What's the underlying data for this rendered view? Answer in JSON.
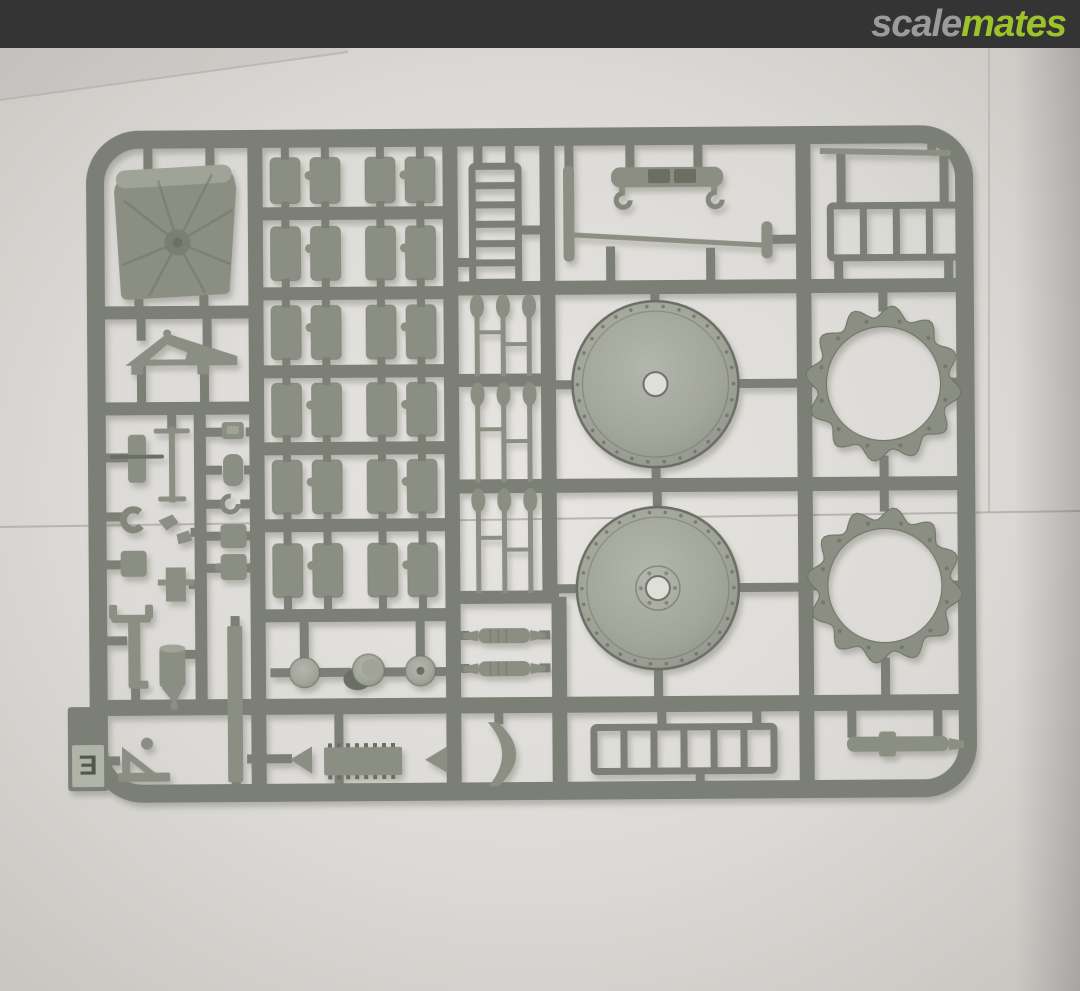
{
  "header": {
    "logo": {
      "scale": "scale",
      "mates": "mates"
    }
  },
  "sprue": {
    "letter": "E"
  },
  "colors": {
    "topbar": "#343434",
    "logo_scale": "#9b9b9b",
    "logo_mates": "#9cc42a",
    "backdrop": "#cac7c3",
    "paper_center": "#e7e5e1",
    "runner": "#7c7f75",
    "plastic": "#8b8e83",
    "plastic_light": "#a0a398",
    "plastic_dark": "#6b6e63",
    "seam": "#b2afac",
    "letter": "#54574d"
  }
}
